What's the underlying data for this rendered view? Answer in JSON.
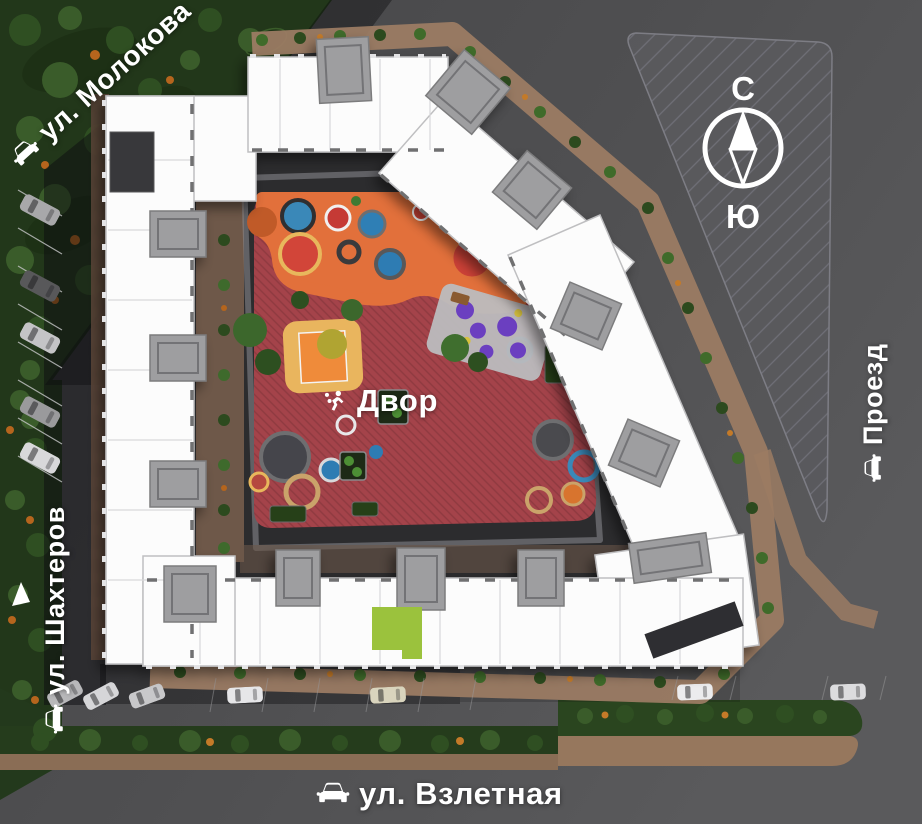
{
  "labels": {
    "street_top_left": {
      "text": "ул. Молокова",
      "icon": "car-icon"
    },
    "street_left": {
      "text": "ул. Шахтеров",
      "icon": "car-icon"
    },
    "street_bottom": {
      "text": "ул. Взлетная",
      "icon": "car-icon"
    },
    "road_right": {
      "text": "Проезд",
      "icon": "car-icon"
    },
    "courtyard": {
      "text": "Двор",
      "icon": "playground-person-icon"
    }
  },
  "compass": {
    "north": "С",
    "south": "Ю"
  },
  "highlighted_section": {
    "state": "selected",
    "color": "#9bc23d"
  },
  "colors": {
    "asphalt": "#4d4d4f",
    "park_green": "#22371a",
    "building_white": "#fcfcfc",
    "stair_core_gray": "#9e9ea0",
    "sidewalk_brown": "#9b7b63",
    "playground_red": "#a4434a",
    "playground_orange": "#e2703b",
    "selection_green": "#9bc23d",
    "label_text": "#ffffff"
  }
}
